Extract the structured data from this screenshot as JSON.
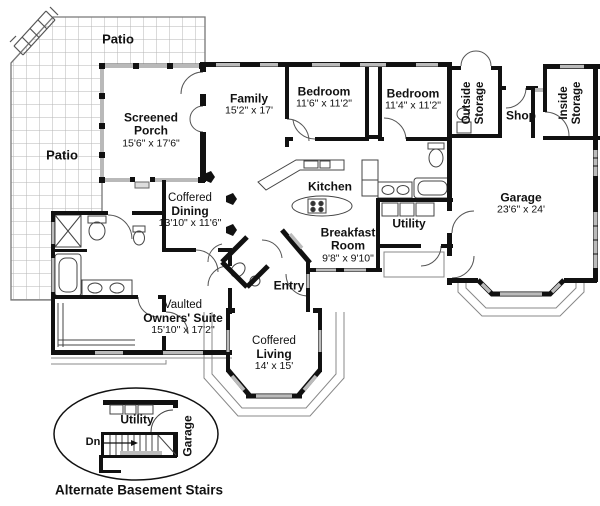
{
  "colors": {
    "wall": "#111111",
    "window_fill": "#bbbbbb",
    "grid_line": "#b5b5b5",
    "thin_line": "#555555",
    "deck_line": "#888888",
    "background": "#ffffff"
  },
  "plan": {
    "patio_top": "Patio",
    "patio_left": "Patio",
    "screened_porch": {
      "line1": "Screened",
      "line2": "Porch",
      "dims": "15'6\" x 17'6\""
    },
    "family": {
      "name": "Family",
      "dims": "15'2\" x 17'"
    },
    "bedroom_1": {
      "name": "Bedroom",
      "dims": "11'6\" x 11'2\""
    },
    "bedroom_2": {
      "name": "Bedroom",
      "dims": "11'4\" x 11'2\""
    },
    "outside_storage": {
      "line1": "Outside",
      "line2": "Storage"
    },
    "shop": {
      "name": "Shop"
    },
    "inside_storage": {
      "line1": "Inside",
      "line2": "Storage"
    },
    "garage": {
      "name": "Garage",
      "dims": "23'6\" x 24'"
    },
    "kitchen": {
      "name": "Kitchen"
    },
    "utility": {
      "name": "Utility"
    },
    "dining": {
      "prefix": "Coffered",
      "name": "Dining",
      "dims": "13'10\" x 11'6\""
    },
    "breakfast": {
      "line1": "Breakfast",
      "line2": "Room",
      "dims": "9'8\" x 9'10\""
    },
    "entry": {
      "name": "Entry"
    },
    "owners_suite": {
      "prefix": "Vaulted",
      "name": "Owners' Suite",
      "dims": "15'10\" x 17'2\""
    },
    "living": {
      "prefix": "Coffered",
      "name": "Living",
      "dims": "14' x 15'"
    }
  },
  "inset": {
    "utility": "Utility",
    "garage": "Garage",
    "down": "Dn",
    "caption": "Alternate Basement Stairs"
  }
}
